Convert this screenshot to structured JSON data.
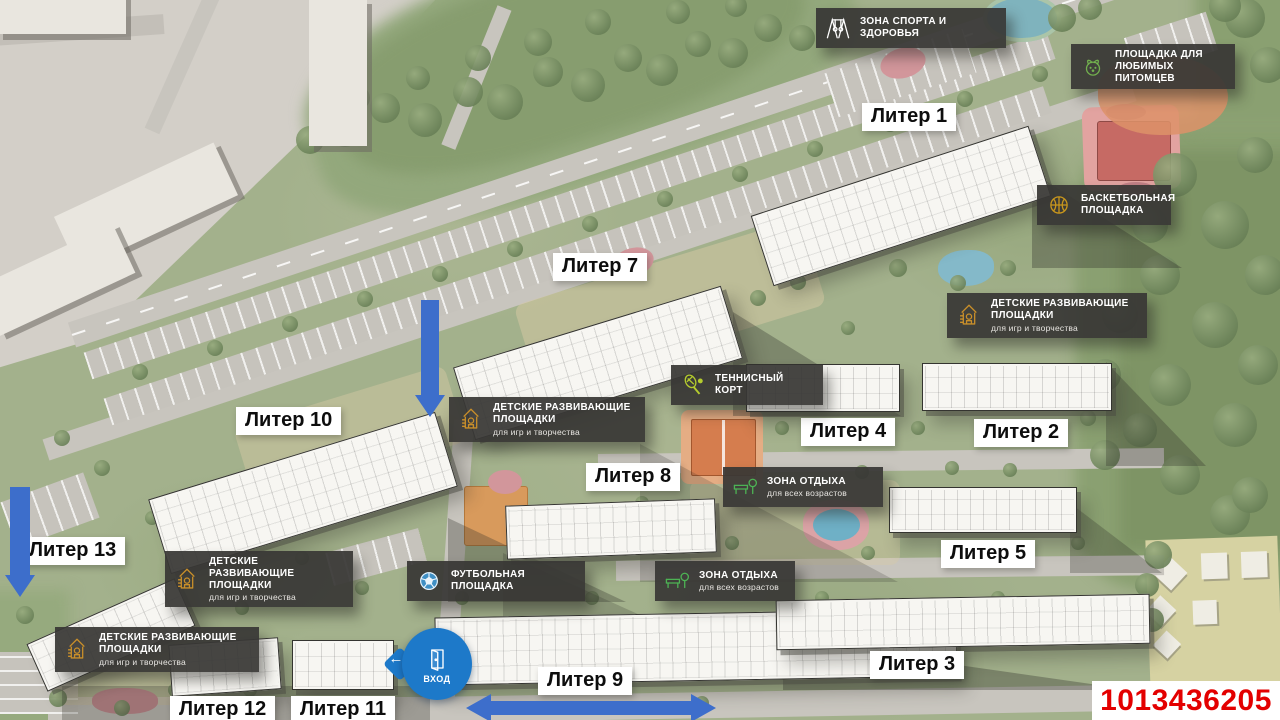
{
  "page": {
    "id_number": "1013436205"
  },
  "entrance": {
    "label": "ВХОД",
    "arrow_glyph": "←"
  },
  "colors": {
    "plate_bg": "#3b3a38",
    "label_bg": "#ffffff",
    "arrow_blue": "#3d6ecb",
    "entrance_blue": "#1d79c9",
    "id_red": "#e30000",
    "basketball_court": "#c66a64",
    "tennis_court": "#d57d4e",
    "icon_gold": "#c98f2a",
    "icon_green": "#4db354"
  },
  "building_labels": [
    {
      "label": "Литер 1",
      "x": 862,
      "y": 103
    },
    {
      "label": "Литер 7",
      "x": 553,
      "y": 253
    },
    {
      "label": "Литер 10",
      "x": 236,
      "y": 407
    },
    {
      "label": "Литер 4",
      "x": 801,
      "y": 418
    },
    {
      "label": "Литер 2",
      "x": 974,
      "y": 419
    },
    {
      "label": "Литер 8",
      "x": 586,
      "y": 463
    },
    {
      "label": "Литер 13",
      "x": 20,
      "y": 537
    },
    {
      "label": "Литер 5",
      "x": 941,
      "y": 540
    },
    {
      "label": "Литер 3",
      "x": 870,
      "y": 651
    },
    {
      "label": "Литер 9",
      "x": 538,
      "y": 667
    },
    {
      "label": "Литер 12",
      "x": 170,
      "y": 696
    },
    {
      "label": "Литер 11",
      "x": 291,
      "y": 696
    }
  ],
  "amenity_labels": [
    {
      "title": "ЗОНА СПОРТА И ЗДОРОВЬЯ",
      "subtitle": "",
      "icon": "gym-icon",
      "x": 816,
      "y": 8,
      "w": 190
    },
    {
      "title": "ПЛОЩАДКА ДЛЯ ЛЮБИМЫХ ПИТОМЦЕВ",
      "subtitle": "",
      "icon": "dog-icon",
      "x": 1071,
      "y": 44,
      "w": 164
    },
    {
      "title": "БАСКЕТБОЛЬНАЯ ПЛОЩАДКА",
      "subtitle": "",
      "icon": "basketball-icon",
      "x": 1037,
      "y": 185,
      "w": 134
    },
    {
      "title": "ДЕТСКИЕ РАЗВИВАЮЩИЕ ПЛОЩАДКИ",
      "subtitle": "для игр и творчества",
      "icon": "playhouse-icon",
      "x": 947,
      "y": 293,
      "w": 200
    },
    {
      "title": "ТЕННИСНЫЙ КОРТ",
      "subtitle": "",
      "icon": "tennis-icon",
      "x": 671,
      "y": 365,
      "w": 152
    },
    {
      "title": "ДЕТСКИЕ РАЗВИВАЮЩИЕ ПЛОЩАДКИ",
      "subtitle": "для игр и творчества",
      "icon": "playhouse-icon",
      "x": 449,
      "y": 397,
      "w": 196
    },
    {
      "title": "ЗОНА ОТДЫХА",
      "subtitle": "для всех возрастов",
      "icon": "bench-icon",
      "x": 723,
      "y": 467,
      "w": 160
    },
    {
      "title": "ДЕТСКИЕ РАЗВИВАЮЩИЕ ПЛОЩАДКИ",
      "subtitle": "для игр и творчества",
      "icon": "playhouse-icon",
      "x": 165,
      "y": 551,
      "w": 188
    },
    {
      "title": "ФУТБОЛЬНАЯ ПЛОЩАДКА",
      "subtitle": "",
      "icon": "soccer-icon",
      "x": 407,
      "y": 561,
      "w": 178
    },
    {
      "title": "ЗОНА ОТДЫХА",
      "subtitle": "для всех возрастов",
      "icon": "bench-icon",
      "x": 655,
      "y": 561,
      "w": 140
    },
    {
      "title": "ДЕТСКИЕ РАЗВИВАЮЩИЕ ПЛОЩАДКИ",
      "subtitle": "для игр и творчества",
      "icon": "playhouse-icon",
      "x": 55,
      "y": 627,
      "w": 204
    }
  ]
}
